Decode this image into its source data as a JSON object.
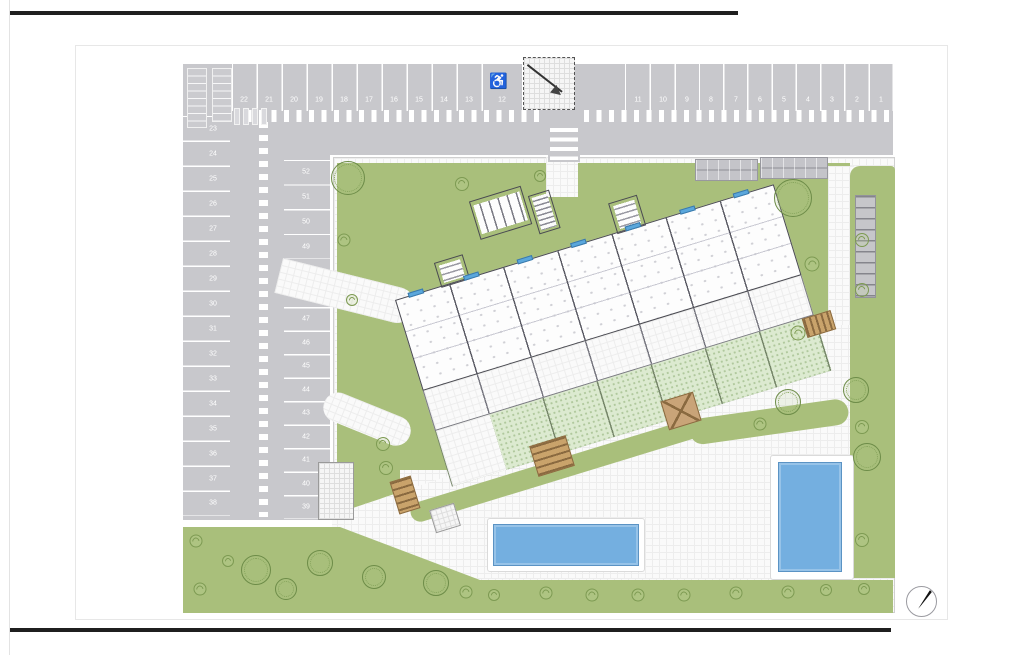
{
  "drawing": {
    "kind": "residential site plan",
    "colors": {
      "parking_gray": "#c8c8cc",
      "lawn_green": "#a9bf7b",
      "private_garden_green": "#dcead0",
      "pool_blue": "#74afe0",
      "wood_brown": "#c9a36b",
      "building_line": "#4a4a52"
    }
  },
  "parking": {
    "handicap_symbol": "♿",
    "top_row": [
      {
        "label": "22",
        "x": 244,
        "y": 100
      },
      {
        "label": "21",
        "x": 269,
        "y": 100
      },
      {
        "label": "20",
        "x": 294,
        "y": 100
      },
      {
        "label": "19",
        "x": 319,
        "y": 100
      },
      {
        "label": "18",
        "x": 344,
        "y": 100
      },
      {
        "label": "17",
        "x": 369,
        "y": 100
      },
      {
        "label": "16",
        "x": 394,
        "y": 100
      },
      {
        "label": "15",
        "x": 419,
        "y": 100
      },
      {
        "label": "14",
        "x": 444,
        "y": 100
      },
      {
        "label": "13",
        "x": 469,
        "y": 100
      },
      {
        "label": "12",
        "x": 502,
        "y": 100
      },
      {
        "label": "11",
        "x": 638,
        "y": 100
      },
      {
        "label": "10",
        "x": 663,
        "y": 100
      },
      {
        "label": "9",
        "x": 687,
        "y": 100
      },
      {
        "label": "8",
        "x": 711,
        "y": 100
      },
      {
        "label": "7",
        "x": 736,
        "y": 100
      },
      {
        "label": "6",
        "x": 760,
        "y": 100
      },
      {
        "label": "5",
        "x": 784,
        "y": 100
      },
      {
        "label": "4",
        "x": 808,
        "y": 100
      },
      {
        "label": "3",
        "x": 832,
        "y": 100
      },
      {
        "label": "2",
        "x": 857,
        "y": 100
      },
      {
        "label": "1",
        "x": 881,
        "y": 100
      }
    ],
    "left_col": [
      {
        "label": "23",
        "x": 213,
        "y": 129
      },
      {
        "label": "24",
        "x": 213,
        "y": 154
      },
      {
        "label": "25",
        "x": 213,
        "y": 179
      },
      {
        "label": "26",
        "x": 213,
        "y": 204
      },
      {
        "label": "27",
        "x": 213,
        "y": 229
      },
      {
        "label": "28",
        "x": 213,
        "y": 254
      },
      {
        "label": "29",
        "x": 213,
        "y": 279
      },
      {
        "label": "30",
        "x": 213,
        "y": 304
      },
      {
        "label": "31",
        "x": 213,
        "y": 329
      },
      {
        "label": "32",
        "x": 213,
        "y": 354
      },
      {
        "label": "33",
        "x": 213,
        "y": 379
      },
      {
        "label": "34",
        "x": 213,
        "y": 404
      },
      {
        "label": "35",
        "x": 213,
        "y": 429
      },
      {
        "label": "36",
        "x": 213,
        "y": 454
      },
      {
        "label": "37",
        "x": 213,
        "y": 479
      },
      {
        "label": "38",
        "x": 213,
        "y": 503
      }
    ],
    "right_col": [
      {
        "label": "52",
        "x": 306,
        "y": 172
      },
      {
        "label": "51",
        "x": 306,
        "y": 197
      },
      {
        "label": "50",
        "x": 306,
        "y": 222
      },
      {
        "label": "49",
        "x": 306,
        "y": 247
      },
      {
        "label": "48",
        "x": 306,
        "y": 296
      },
      {
        "label": "47",
        "x": 306,
        "y": 319
      },
      {
        "label": "46",
        "x": 306,
        "y": 343
      },
      {
        "label": "45",
        "x": 306,
        "y": 366
      },
      {
        "label": "44",
        "x": 306,
        "y": 390
      },
      {
        "label": "43",
        "x": 306,
        "y": 413
      },
      {
        "label": "42",
        "x": 306,
        "y": 437
      },
      {
        "label": "41",
        "x": 306,
        "y": 460
      },
      {
        "label": "40",
        "x": 306,
        "y": 484
      },
      {
        "label": "39",
        "x": 306,
        "y": 507
      }
    ]
  },
  "building": {
    "facade_windows": [
      {
        "x": 14
      },
      {
        "x": 72
      },
      {
        "x": 128
      },
      {
        "x": 184
      },
      {
        "x": 241
      },
      {
        "x": 298
      },
      {
        "x": 354
      }
    ]
  },
  "landscape": {
    "trees": [
      {
        "t": "sc",
        "x": 348,
        "y": 178,
        "s": 34
      },
      {
        "t": "sp",
        "x": 462,
        "y": 184,
        "s": 14
      },
      {
        "t": "sp",
        "x": 344,
        "y": 240,
        "s": 13
      },
      {
        "t": "sp",
        "x": 352,
        "y": 300,
        "s": 12
      },
      {
        "t": "sp",
        "x": 540,
        "y": 176,
        "s": 12
      },
      {
        "t": "sc",
        "x": 793,
        "y": 198,
        "s": 38
      },
      {
        "t": "sp",
        "x": 812,
        "y": 264,
        "s": 15
      },
      {
        "t": "sp",
        "x": 798,
        "y": 333,
        "s": 15
      },
      {
        "t": "sc",
        "x": 788,
        "y": 402,
        "s": 26
      },
      {
        "t": "sp",
        "x": 760,
        "y": 424,
        "s": 13
      },
      {
        "t": "sc",
        "x": 856,
        "y": 390,
        "s": 26
      },
      {
        "t": "sc",
        "x": 867,
        "y": 457,
        "s": 28
      },
      {
        "t": "sp",
        "x": 862,
        "y": 240,
        "s": 14
      },
      {
        "t": "sp",
        "x": 862,
        "y": 290,
        "s": 14
      },
      {
        "t": "sp",
        "x": 862,
        "y": 427,
        "s": 14
      },
      {
        "t": "sp",
        "x": 862,
        "y": 540,
        "s": 14
      },
      {
        "t": "sp",
        "x": 383,
        "y": 444,
        "s": 14
      },
      {
        "t": "sp",
        "x": 386,
        "y": 468,
        "s": 14
      },
      {
        "t": "sc",
        "x": 256,
        "y": 570,
        "s": 30
      },
      {
        "t": "sc",
        "x": 320,
        "y": 563,
        "s": 26
      },
      {
        "t": "sc",
        "x": 286,
        "y": 589,
        "s": 22
      },
      {
        "t": "sc",
        "x": 374,
        "y": 577,
        "s": 24
      },
      {
        "t": "sc",
        "x": 436,
        "y": 583,
        "s": 26
      },
      {
        "t": "sp",
        "x": 196,
        "y": 541,
        "s": 13
      },
      {
        "t": "sp",
        "x": 228,
        "y": 561,
        "s": 12
      },
      {
        "t": "sp",
        "x": 200,
        "y": 589,
        "s": 13
      },
      {
        "t": "sp",
        "x": 466,
        "y": 592,
        "s": 13
      },
      {
        "t": "sp",
        "x": 494,
        "y": 595,
        "s": 12
      },
      {
        "t": "sp",
        "x": 546,
        "y": 593,
        "s": 13
      },
      {
        "t": "sp",
        "x": 592,
        "y": 595,
        "s": 13
      },
      {
        "t": "sp",
        "x": 638,
        "y": 595,
        "s": 13
      },
      {
        "t": "sp",
        "x": 684,
        "y": 595,
        "s": 13
      },
      {
        "t": "sp",
        "x": 736,
        "y": 593,
        "s": 13
      },
      {
        "t": "sp",
        "x": 788,
        "y": 592,
        "s": 13
      },
      {
        "t": "sp",
        "x": 826,
        "y": 590,
        "s": 12
      },
      {
        "t": "sp",
        "x": 864,
        "y": 589,
        "s": 12
      }
    ]
  }
}
